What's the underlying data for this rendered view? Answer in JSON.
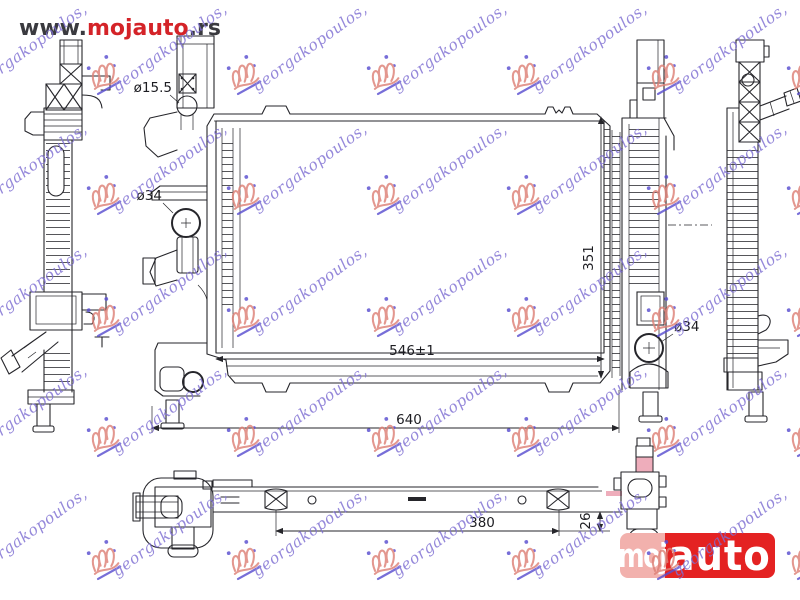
{
  "site": {
    "url_prefix": "www.",
    "url_brand": "mojauto",
    "url_suffix": ".rs"
  },
  "brand_badge": {
    "part1": "moj",
    "part2": "auto"
  },
  "watermark": {
    "text": "georgakopoulos,"
  },
  "colors": {
    "brand_red": "#d42328",
    "url_dark": "#3a3a3f",
    "badge_pink": "#f2b1ad",
    "badge_red": "#e42222",
    "watermark_text": "#7e6fd2",
    "watermark_crown": "#dd8177",
    "watermark_accent": "#5a4fd0",
    "line": "#26262b",
    "highlight_pink": "#eeadbb"
  },
  "drawing": {
    "dimensions": {
      "top_port_diameter": "ø15.5",
      "left_port_diameter": "ø34",
      "right_port_diameter": "ø34",
      "core_width": "546±1",
      "core_height": "351",
      "overall_width": "640",
      "lower_bar_spacing": "380",
      "lower_bar_depth": "26"
    }
  }
}
